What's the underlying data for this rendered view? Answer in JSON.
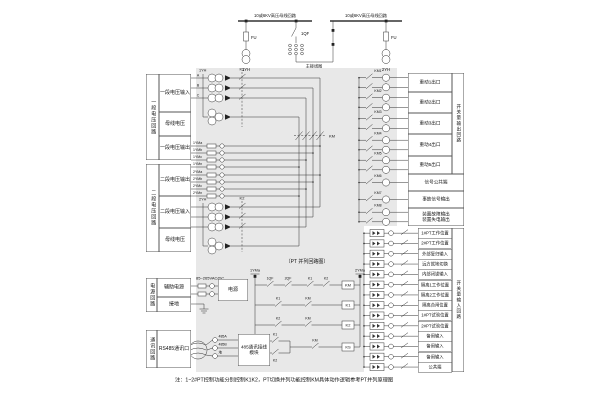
{
  "note": "注：1~2#PT控制功能分别控制K1K2，PT切换并列功能控制KM具体动作逻辑参考PT并列原理图",
  "top": {
    "bus_left_label": "10或6KV高压母线回路",
    "bus_right_label": "10或6KV高压母线回路",
    "fu_left": "FU",
    "fu_right": "FU",
    "qf_label": "1QF",
    "pt_left": "1YH",
    "pt_right": "2YH",
    "main_link_label": "主接线图"
  },
  "left_panel": {
    "groups": [
      {
        "side": "一段电压回路",
        "cells": [
          "一段电压输入",
          "母线电压",
          "一段电压输出"
        ]
      },
      {
        "side": "二段电压回路",
        "cells": [
          "二段电压输出",
          "二段电压输入",
          "母线电压"
        ]
      },
      {
        "side": "电源回路",
        "cells": [
          "辅助电源",
          "接地"
        ]
      },
      {
        "side": "通讯回路",
        "cells": [
          "RS485通讯口"
        ]
      }
    ]
  },
  "middle": {
    "pt1_label": "1YH",
    "pt2_label": "2YH",
    "phases": [
      "A",
      "B",
      "C"
    ],
    "k1": "K1",
    "k2": "K2",
    "km": "KM",
    "ym1": [
      "1YMa",
      "1YMb",
      "1YMc",
      "1YMn"
    ],
    "ym2": [
      "2YMa",
      "2YMb",
      "2YMc",
      "2YMn"
    ],
    "power": {
      "range": "85~265VAC/DC",
      "module": "电源"
    },
    "comm": {
      "terminals": [
        "485A",
        "485B",
        "地"
      ],
      "module": "485通讯接线模块"
    },
    "ladder": {
      "title": "〔PT 并列回路图〕",
      "rail_left": "1YMa",
      "rail_right": "2YMa",
      "rungs": [
        {
          "contacts": [
            "1QF",
            "2QF",
            "K1",
            "K2"
          ],
          "coil": "KM"
        },
        {
          "contacts": [
            "K1",
            "KM"
          ],
          "coil": "K1"
        },
        {
          "contacts": [
            "K2",
            "KM"
          ],
          "coil": "K2"
        },
        {
          "branch": [
            "K1",
            "K2"
          ],
          "contacts": [
            "KM"
          ],
          "coil": "KS"
        }
      ]
    }
  },
  "outputs": {
    "column_label": "开关量输出回路",
    "boxes": [
      {
        "label": "重动1出口",
        "coil": "KM1"
      },
      {
        "label": "重动2出口",
        "coil": "KM2"
      },
      {
        "label": "重动3出口",
        "coil": "KM3"
      },
      {
        "label": "重动4出口",
        "coil": "KM4"
      },
      {
        "label": "重动5出口",
        "coil": "KM5"
      }
    ],
    "wide_boxes": [
      {
        "label": "信号公共端",
        "coil": "KM6"
      },
      {
        "label": "事故信号输出",
        "coil": "KM7"
      },
      {
        "label": "装置故障输出",
        "label2": "装置失电输出",
        "coil": "KM8"
      }
    ]
  },
  "inputs": {
    "column_label": "开关量输入回路",
    "rows": [
      "1#PT工作位置",
      "2#PT工作位置",
      "外部复归输入",
      "远方就地切换",
      "内部闭锁输入",
      "隔离1工作位置",
      "隔离2工作位置",
      "隔离合闸位置",
      "1#PT试验位置",
      "2#PT试验位置",
      "备用输入",
      "备用输入",
      "备用输入",
      "公共端"
    ]
  }
}
